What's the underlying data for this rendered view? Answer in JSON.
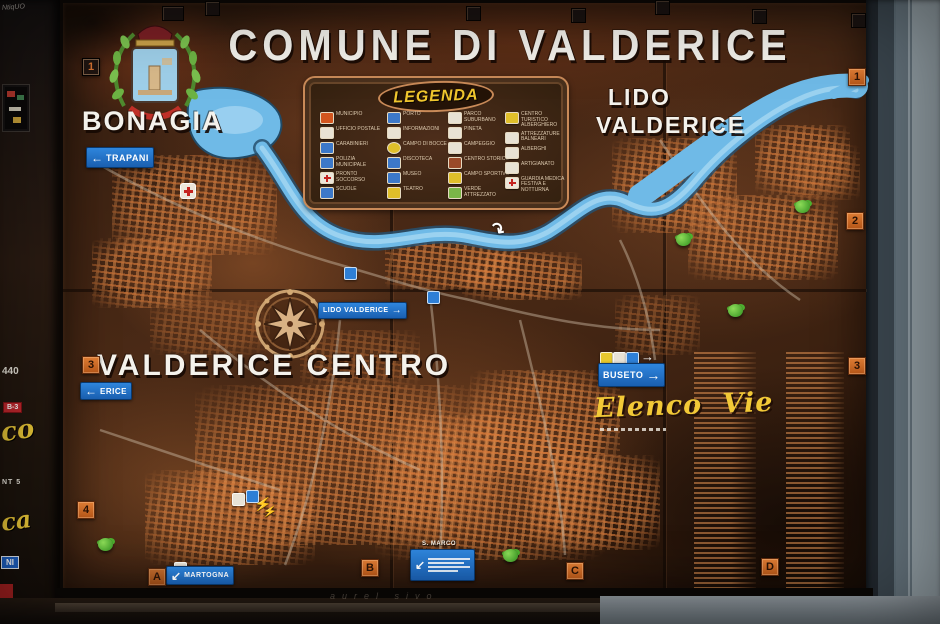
{
  "board": {
    "title": "COMUNE DI VALDERICE",
    "areas": {
      "bonagia": "BONAGIA",
      "lido_line1": "LIDO",
      "lido_line2": "VALDERICE",
      "centro": "VALDERICE CENTRO",
      "elenco_vie": "Elenco Vie",
      "san_marco": "S. MARCO"
    }
  },
  "legend": {
    "title": "LEGENDA",
    "columns": [
      [
        {
          "label": "MUNICIPIO"
        },
        {
          "label": "UFFICIO POSTALE"
        },
        {
          "label": "CARABINIERI"
        },
        {
          "label": "POLIZIA MUNICIPALE"
        },
        {
          "label": "PRONTO SOCCORSO"
        },
        {
          "label": "SCUOLE"
        }
      ],
      [
        {
          "label": "PORTO"
        },
        {
          "label": "INFORMAZIONI"
        },
        {
          "label": "CAMPO DI BOCCE"
        },
        {
          "label": "DISCOTECA"
        },
        {
          "label": "MUSEO"
        },
        {
          "label": "TEATRO"
        }
      ],
      [
        {
          "label": "PARCO SUBURBANO"
        },
        {
          "label": "PINETA"
        },
        {
          "label": "CAMPEGGIO"
        },
        {
          "label": "CENTRO STORICO"
        },
        {
          "label": "CAMPO SPORTIVO"
        },
        {
          "label": "VERDE ATTREZZATO"
        }
      ],
      [
        {
          "label": "CENTRO TURISTICO ALBERGHIERO"
        },
        {
          "label": "ATTREZZATURE BALNEARI"
        },
        {
          "label": "ALBERGHI"
        },
        {
          "label": "ARTIGIANATO"
        },
        {
          "label": "GUARDIA MEDICA FESTIVA E NOTTURNA"
        }
      ]
    ]
  },
  "signs": {
    "trapani": "TRAPANI",
    "lido_valderice": "LIDO VALDERICE",
    "erice": "ERICE",
    "buseto": "BUSETO",
    "martogna": "MARTOGNA"
  },
  "grid": {
    "top_left": "1",
    "right_1": "1",
    "right_2": "2",
    "right_3": "3",
    "left_3": "3",
    "left_4": "4",
    "bottom_a": "A",
    "bottom_b": "B",
    "bottom_c": "C",
    "bottom_d": "D"
  },
  "left_strip": {
    "num": "440",
    "badge": "B-3",
    "script1": "co",
    "small": "NT 5",
    "script2": "ca",
    "tag": "NI",
    "scribble": "NtiqUO"
  },
  "graffiti": "aurel      sivo",
  "colors": {
    "board_copper": "#8a5a33",
    "water": "#6fbae7",
    "sign_blue": "#1d6ec9",
    "marker_orange": "#cf6b2a",
    "legend_yellow": "#f0c62e",
    "title_white": "#f4f2ec"
  }
}
